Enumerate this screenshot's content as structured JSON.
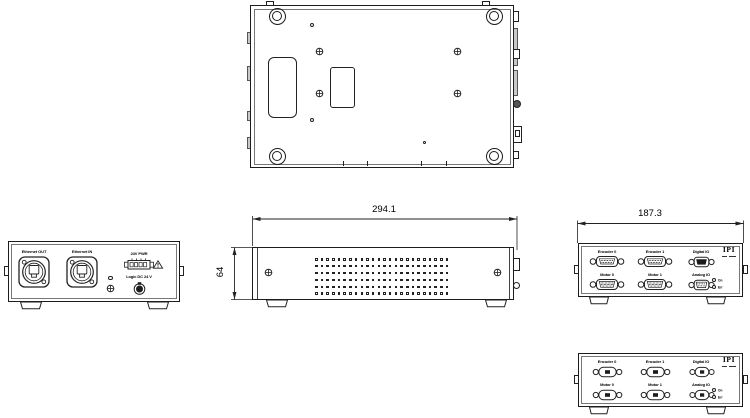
{
  "drawing": {
    "dimensions": {
      "width_label": "294.1",
      "height_label": "64",
      "depth_label": "187.3"
    },
    "rear_panel": {
      "ethernet_out": "Ethernet OUT",
      "ethernet_in": "Ethernet IN",
      "power": "24V PWR",
      "logic": "Logic DC 24 V",
      "warning_symbol": "⚠"
    },
    "io_panel": {
      "logo": "IPI",
      "encoder0": "Encoder 0",
      "encoder1": "Encoder 1",
      "digital_io": "Digital IO",
      "motor0": "Motor 0",
      "motor1": "Motor 1",
      "analog_io": "Analog IO",
      "led_on": "On",
      "led_err": "Err"
    },
    "colors": {
      "line": "#1c1c1c",
      "shading": "#c9c9c9",
      "background": "#ffffff"
    }
  }
}
